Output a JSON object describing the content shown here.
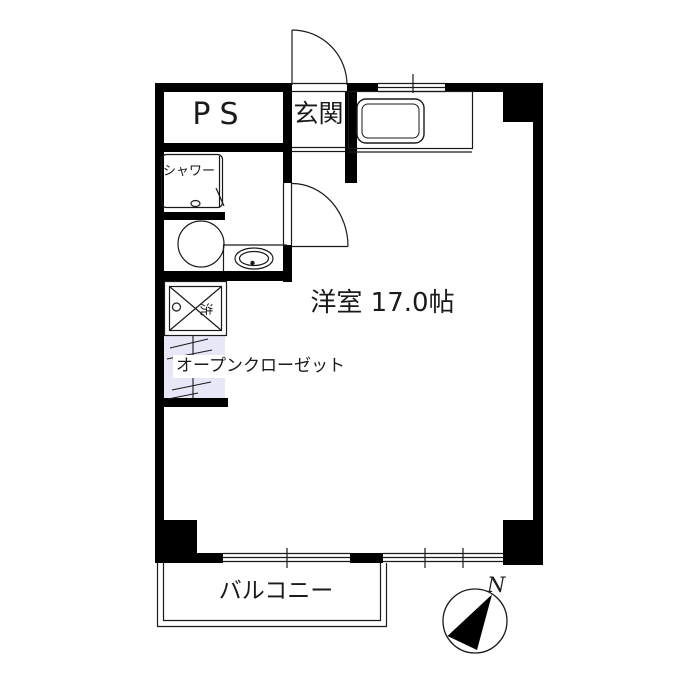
{
  "floorplan": {
    "rooms": {
      "ps": {
        "label": "PS"
      },
      "genkan": {
        "label": "玄関"
      },
      "shower": {
        "label": "シャワー"
      },
      "main": {
        "label": "洋室 17.0帖"
      },
      "closet": {
        "label": "オープンクローゼット"
      },
      "balcony": {
        "label": "バルコニー"
      }
    },
    "symbols": {
      "washer": "洗",
      "north": "N"
    },
    "colors": {
      "wall": "#000000",
      "line": "#1a1a1a",
      "closet_fill": "#e7e7f7",
      "background": "#ffffff"
    }
  }
}
